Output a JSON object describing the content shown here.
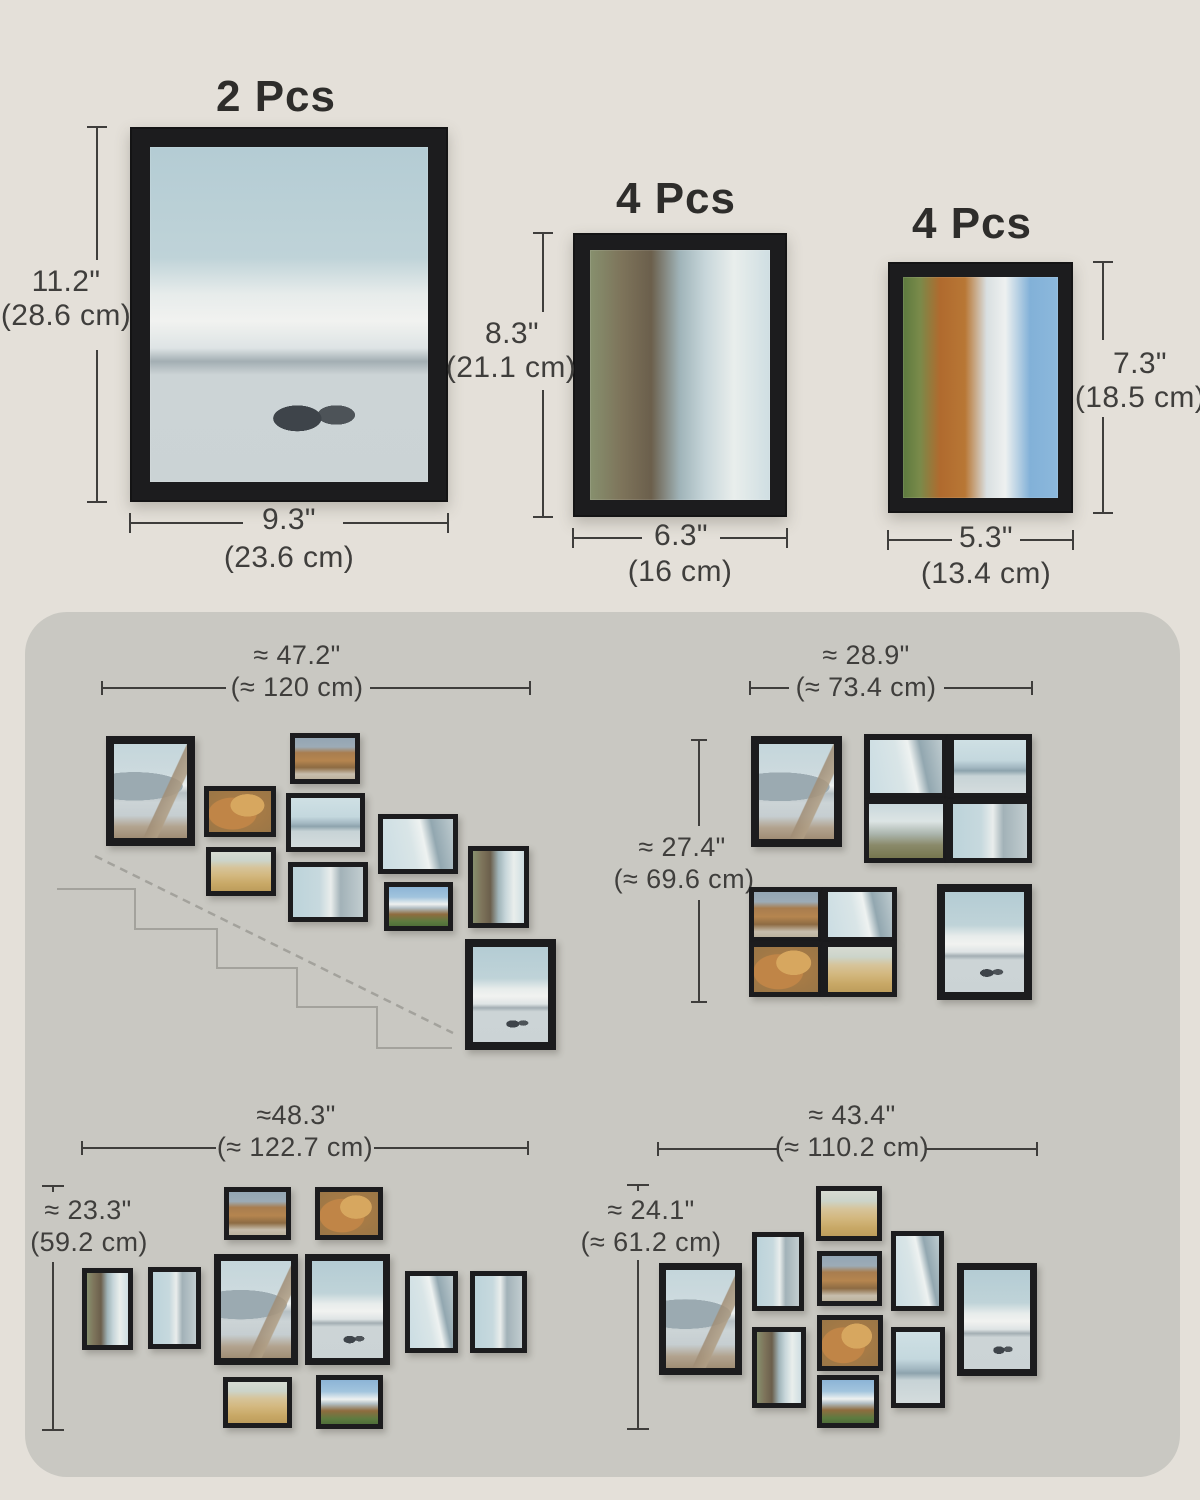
{
  "colors": {
    "background": "#e4e0d9",
    "panel": "#c9c8c2",
    "frame": "#1c1c1e",
    "dimension_text": "#3f3e3c",
    "staircase_line": "#a3a29c"
  },
  "top_specs": [
    {
      "pcs_label": "2 Pcs",
      "height_in": "11.2\"",
      "height_cm": "(28.6 cm)",
      "width_in": "9.3\"",
      "width_cm": "(23.6 cm)",
      "photo": "sailboats"
    },
    {
      "pcs_label": "4 Pcs",
      "height_in": "8.3\"",
      "height_cm": "(21.1 cm)",
      "width_in": "6.3\"",
      "width_cm": "(16 cm)",
      "photo": "lake-rot"
    },
    {
      "pcs_label": "4 Pcs",
      "height_in": "7.3\"",
      "height_cm": "(18.5 cm)",
      "width_in": "5.3\"",
      "width_cm": "(13.4 cm)",
      "photo": "mountain-rot"
    }
  ],
  "arrangements": [
    {
      "name": "staircase",
      "width_in": "≈ 47.2\"",
      "width_cm": "(≈ 120 cm)",
      "frames": [
        {
          "x": 106,
          "y": 736,
          "w": 89,
          "h": 110,
          "photo": "dock"
        },
        {
          "x": 204,
          "y": 786,
          "w": 72,
          "h": 51,
          "photo": "leaves"
        },
        {
          "x": 290,
          "y": 733,
          "w": 70,
          "h": 51,
          "photo": "autumn-hill"
        },
        {
          "x": 286,
          "y": 793,
          "w": 79,
          "h": 59,
          "photo": "lake-mist"
        },
        {
          "x": 206,
          "y": 847,
          "w": 70,
          "h": 49,
          "photo": "grass"
        },
        {
          "x": 288,
          "y": 862,
          "w": 80,
          "h": 60,
          "photo": "shore-rot"
        },
        {
          "x": 378,
          "y": 814,
          "w": 80,
          "h": 60,
          "photo": "ice-rot"
        },
        {
          "x": 384,
          "y": 882,
          "w": 69,
          "h": 49,
          "photo": "mountain-snow"
        },
        {
          "x": 468,
          "y": 846,
          "w": 61,
          "h": 82,
          "photo": "lake-rot"
        },
        {
          "x": 465,
          "y": 939,
          "w": 91,
          "h": 111,
          "photo": "sailboats"
        }
      ]
    },
    {
      "name": "two-block",
      "width_in": "≈ 28.9\"",
      "width_cm": "(≈ 73.4 cm)",
      "height_in": "≈ 27.4\"",
      "height_cm": "(≈ 69.6 cm)",
      "frames": [
        {
          "x": 751,
          "y": 736,
          "w": 91,
          "h": 111,
          "photo": "dock"
        },
        {
          "x": 864,
          "y": 734,
          "w": 84,
          "h": 65,
          "photo": "ice-rot"
        },
        {
          "x": 948,
          "y": 734,
          "w": 84,
          "h": 65,
          "photo": "lake-mist"
        },
        {
          "x": 864,
          "y": 799,
          "w": 84,
          "h": 64,
          "photo": "marsh"
        },
        {
          "x": 948,
          "y": 799,
          "w": 84,
          "h": 64,
          "photo": "shore-rot"
        },
        {
          "x": 749,
          "y": 887,
          "w": 74,
          "h": 55,
          "photo": "autumn-hill"
        },
        {
          "x": 823,
          "y": 887,
          "w": 74,
          "h": 55,
          "photo": "ice-rot"
        },
        {
          "x": 749,
          "y": 942,
          "w": 74,
          "h": 55,
          "photo": "leaves"
        },
        {
          "x": 823,
          "y": 942,
          "w": 74,
          "h": 55,
          "photo": "grass"
        },
        {
          "x": 937,
          "y": 884,
          "w": 95,
          "h": 116,
          "photo": "sailboats"
        }
      ]
    },
    {
      "name": "wide-diamond",
      "width_in": "≈48.3\"",
      "width_cm": "(≈ 122.7 cm)",
      "height_in": "≈ 23.3\"",
      "height_cm": "(59.2 cm)",
      "frames": [
        {
          "x": 224,
          "y": 1187,
          "w": 67,
          "h": 53,
          "photo": "autumn-hill"
        },
        {
          "x": 315,
          "y": 1187,
          "w": 68,
          "h": 53,
          "photo": "leaves"
        },
        {
          "x": 82,
          "y": 1268,
          "w": 51,
          "h": 82,
          "photo": "lake-rot"
        },
        {
          "x": 148,
          "y": 1267,
          "w": 53,
          "h": 82,
          "photo": "shore-rot"
        },
        {
          "x": 214,
          "y": 1254,
          "w": 84,
          "h": 111,
          "photo": "dock"
        },
        {
          "x": 305,
          "y": 1254,
          "w": 85,
          "h": 111,
          "photo": "sailboats"
        },
        {
          "x": 405,
          "y": 1271,
          "w": 53,
          "h": 82,
          "photo": "ice-rot"
        },
        {
          "x": 470,
          "y": 1271,
          "w": 57,
          "h": 82,
          "photo": "shore-rot"
        },
        {
          "x": 223,
          "y": 1377,
          "w": 69,
          "h": 51,
          "photo": "grass"
        },
        {
          "x": 316,
          "y": 1375,
          "w": 67,
          "h": 54,
          "photo": "mountain-snow"
        }
      ]
    },
    {
      "name": "diamond",
      "width_in": "≈ 43.4\"",
      "width_cm": "(≈ 110.2 cm)",
      "height_in": "≈ 24.1\"",
      "height_cm": "(≈ 61.2 cm)",
      "frames": [
        {
          "x": 659,
          "y": 1263,
          "w": 83,
          "h": 112,
          "photo": "dock"
        },
        {
          "x": 752,
          "y": 1232,
          "w": 52,
          "h": 79,
          "photo": "shore-rot"
        },
        {
          "x": 752,
          "y": 1327,
          "w": 54,
          "h": 81,
          "photo": "lake-rot"
        },
        {
          "x": 816,
          "y": 1186,
          "w": 66,
          "h": 55,
          "photo": "grass"
        },
        {
          "x": 817,
          "y": 1251,
          "w": 65,
          "h": 55,
          "photo": "autumn-hill"
        },
        {
          "x": 817,
          "y": 1315,
          "w": 66,
          "h": 56,
          "photo": "leaves"
        },
        {
          "x": 817,
          "y": 1375,
          "w": 62,
          "h": 53,
          "photo": "mountain-snow"
        },
        {
          "x": 891,
          "y": 1231,
          "w": 53,
          "h": 80,
          "photo": "ice-rot"
        },
        {
          "x": 891,
          "y": 1327,
          "w": 54,
          "h": 81,
          "photo": "lake-mist"
        },
        {
          "x": 957,
          "y": 1263,
          "w": 80,
          "h": 113,
          "photo": "sailboats"
        }
      ]
    }
  ]
}
